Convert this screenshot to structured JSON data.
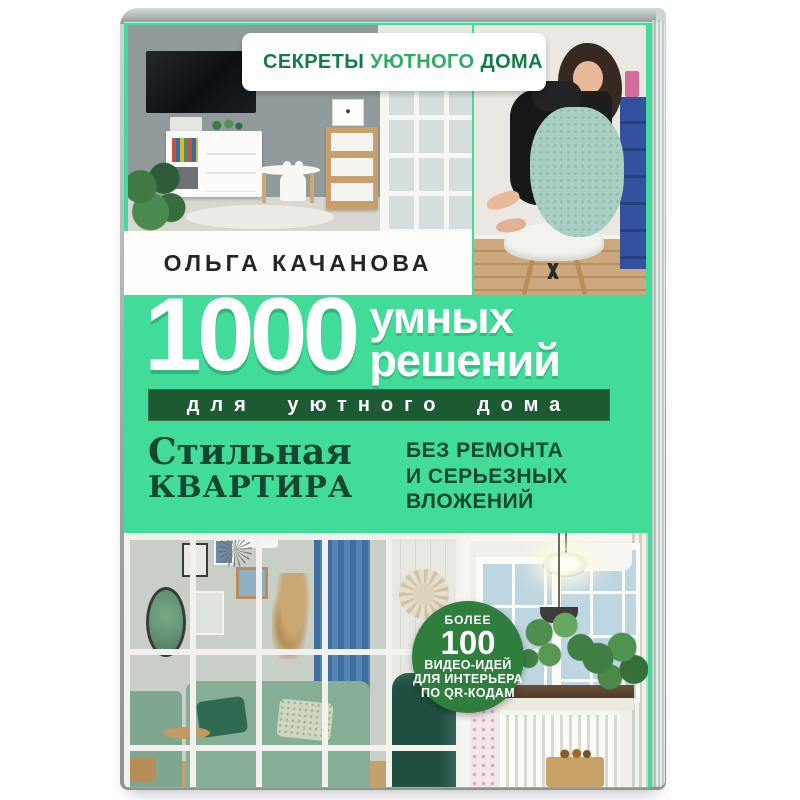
{
  "book": {
    "imprint": {
      "icon": "house-leaf-icon",
      "word1": "СЕКРЕТЫ",
      "word2": "УЮТНОГО",
      "word3": "ДОМА"
    },
    "author": "ОЛЬГА КАЧАНОВА",
    "title": {
      "number": "1000",
      "word_line1": "умных",
      "word_line2": "решений"
    },
    "title_band": "для уютного дома",
    "subtitle_serif": {
      "line1": "Стильная",
      "line2": "КВАРТИРА"
    },
    "subtitle_right": {
      "line1": "БЕЗ РЕМОНТА",
      "line2": "И СЕРЬЕЗНЫХ",
      "line3": "ВЛОЖЕНИЙ"
    },
    "badge": {
      "line1": "БОЛЕЕ",
      "line2": "100",
      "line3": "ВИДЕО-ИДЕЙ",
      "line4": "ДЛЯ ИНТЕРЬЕРА",
      "line5": "ПО QR-КОДАМ"
    },
    "colors": {
      "mint": "#42dc9a",
      "dark_band": "#1d5a34",
      "dark_text": "#14472e",
      "badge_green": "#2f7e3e",
      "logo_dark": "#147a4a",
      "logo_light": "#31ab62",
      "logo_stroke": "#28a25b"
    }
  }
}
